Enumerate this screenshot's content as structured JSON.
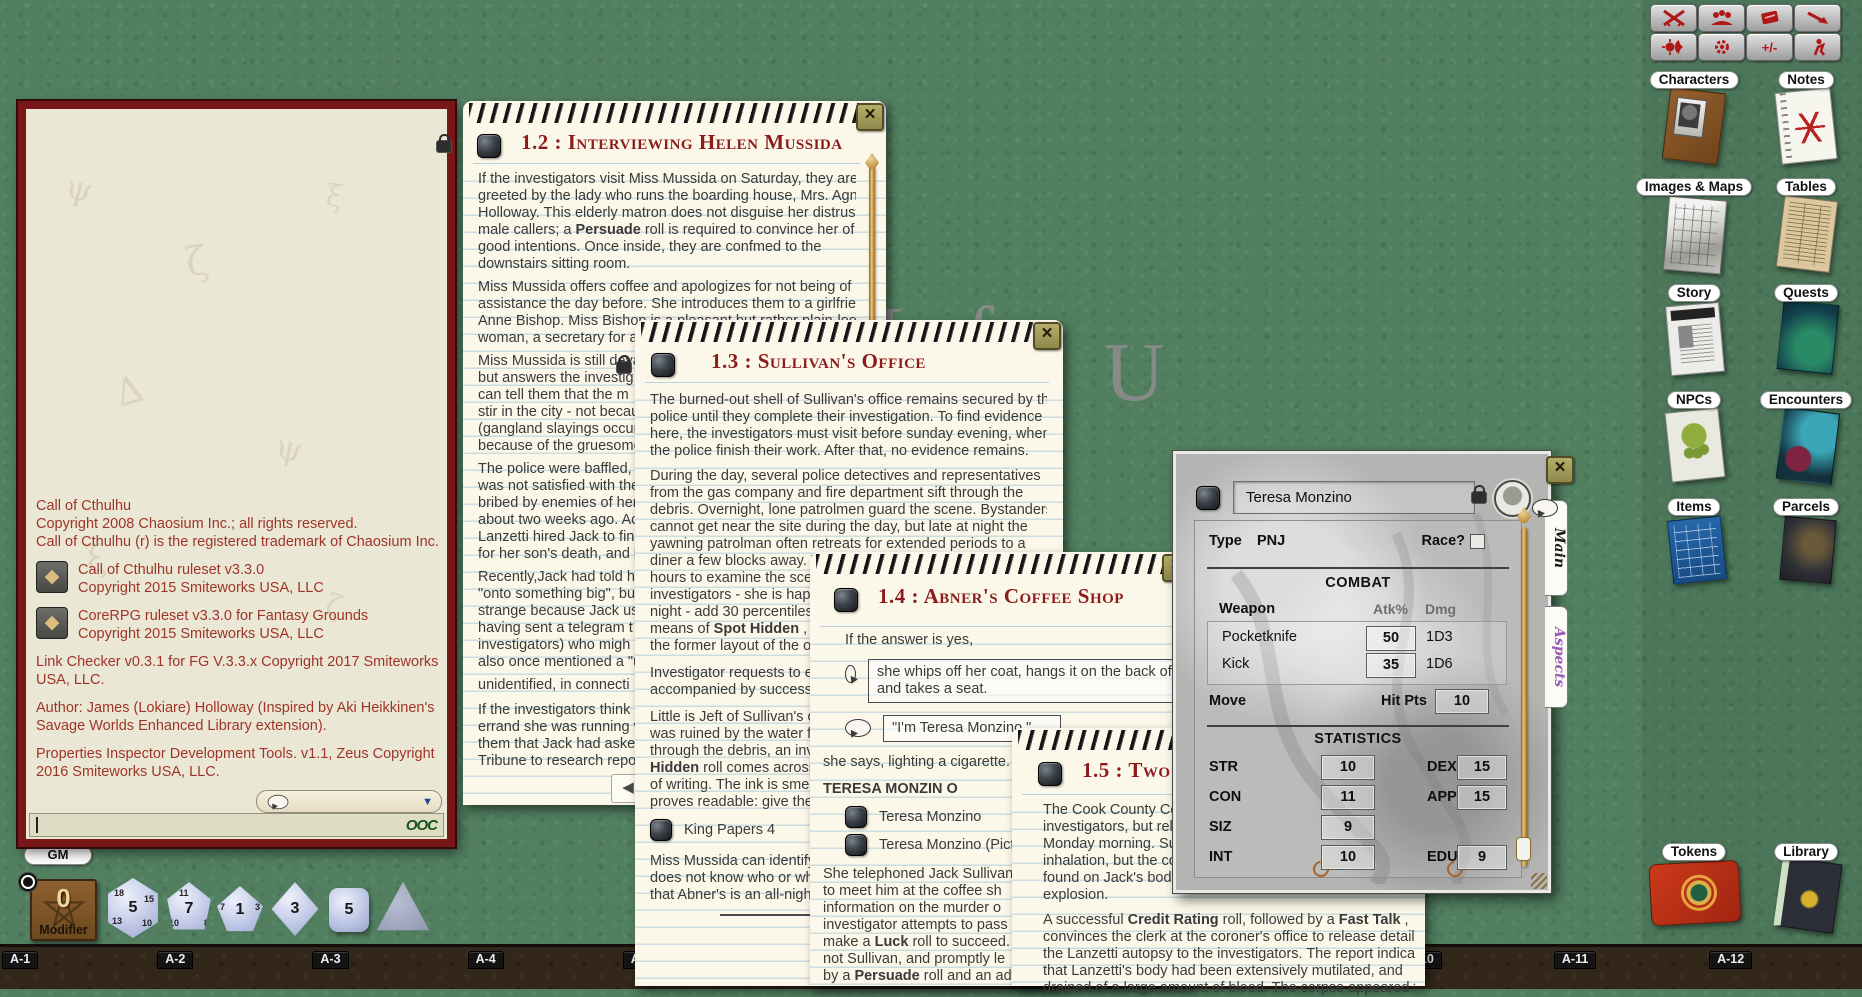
{
  "desktop": {
    "watermark_part1": "M of",
    "watermark_part2": "U",
    "background_green": "#517f60",
    "bottom_bar_brown": "#33261a"
  },
  "toolbar": {
    "icons": [
      "crossed-swords-icon",
      "people-icon",
      "red-deck-icon",
      "pointer-arrow-icon",
      "sun-moon-icon",
      "gear-icon",
      "plus-minus-icon",
      "person-icon"
    ],
    "plus_minus_label": "+/-",
    "accent_red": "#b01818"
  },
  "sidebar": {
    "items": [
      {
        "label": "Characters"
      },
      {
        "label": "Notes"
      },
      {
        "label": "Images & Maps"
      },
      {
        "label": "Tables"
      },
      {
        "label": "Story"
      },
      {
        "label": "Quests"
      },
      {
        "label": "NPCs"
      },
      {
        "label": "Encounters"
      },
      {
        "label": "Items"
      },
      {
        "label": "Parcels"
      },
      {
        "label": "Tokens"
      },
      {
        "label": "Library"
      }
    ]
  },
  "chat": {
    "msg1": "Call of Cthulhu",
    "msg2": "Copyright 2008 Chaosium Inc.; all rights reserved.",
    "msg3": "Call of Cthulhu (r) is the registered trademark of Chaosium Inc.",
    "ruleset1_line1": "Call of Cthulhu ruleset v3.3.0",
    "ruleset1_line2": "Copyright 2015 Smiteworks USA, LLC",
    "ruleset2_line1": "CoreRPG ruleset v3.3.0 for Fantasy Grounds",
    "ruleset2_line2": "Copyright 2015 Smiteworks USA, LLC",
    "msg4": "Link Checker v0.3.1 for FG V.3.3.x Copyright 2017 Smiteworks USA, LLC.",
    "msg5": "Author: James (Lokiare) Holloway (Inspired by Aki Heikkinen's Savage Worlds Enhanced Library extension).",
    "msg6": "Properties Inspector Development Tools. v1.1, Zeus Copyright 2016 Smiteworks USA, LLC.",
    "dice_icon": "d20-glyph",
    "ooc_label": "OOC",
    "dropdown_caret": "▼"
  },
  "gm_label": "GM",
  "modifier": {
    "value": "0",
    "label": "Modifier"
  },
  "dice": {
    "d20": {
      "main": "5",
      "f1": "18",
      "f2": "15",
      "f3": "13",
      "f4": "10"
    },
    "d12": {
      "main": "7",
      "f1": "11",
      "f2": "10",
      "f3": "8"
    },
    "d10": {
      "main": "1",
      "f1": "7",
      "f2": "3"
    },
    "d8": {
      "main": "3"
    },
    "d6": {
      "main": "5"
    }
  },
  "hotbar": {
    "slots": [
      "A-1",
      "A-2",
      "A-3",
      "A-4",
      "A-5",
      "A-6",
      "A-7",
      "A-8",
      "A-9",
      "A-10",
      "A-11",
      "A-12"
    ]
  },
  "win12": {
    "title": "1.2 : Interviewing Helen Mussida",
    "nav_left": "◀",
    "p1": [
      "If the investigators visit Miss Mussida on Saturday, they are",
      "greeted by the lady who runs the boarding house, Mrs. Agnes",
      "Holloway. This elderly matron does not disguise her distrust of",
      "male callers; a **Persuade** roll is required to convince her of their",
      "good intentions. Once inside, they are confmed to the",
      "downstairs sitting room."
    ],
    "p2": [
      "Miss Mussida offers coffee and apologizes for not being of more",
      "assistance the day before. She introduces them to a girlfriend,",
      "Anne Bishop. Miss Bishop is a pleasant but rather plain-looking",
      "woman, a secretary for a b"
    ],
    "p3": [
      "Miss Mussida is still devas",
      "but answers the investig",
      "can tell them that the m",
      "stir in the city - not becau",
      "(gangland slayings occur",
      "because of the gruesome"
    ],
    "p4": [
      "The police were baffled,",
      "was not satisfied with the",
      "bribed by enemies of her",
      "about two weeks ago. Ac",
      "Lanzetti hired Jack to fin",
      "for her son's death, and b"
    ],
    "p5": [
      "Recently,Jack had told hi",
      "\"onto something big\", bu",
      "strange because Jack usu",
      "having sent a telegram t",
      "investigators) who migh",
      "also once mentioned a \"u"
    ],
    "p6": [
      "unidentified, in connecti"
    ],
    "p7": [
      "If the investigators think",
      "errand she was running v",
      "them that Jack had asked",
      "Tribune to research repo"
    ]
  },
  "win13": {
    "title": "1.3 : Sullivan's Office",
    "p1": [
      "The burned-out shell of Sullivan's office remains secured by the",
      "police until they complete their investigation. To find evidence",
      "here, the investigators must visit before sunday evening, when",
      "the police finish their work. After that, no evidence remains."
    ],
    "p2": [
      "During the day, several police detectives and representatives",
      "from the gas company and fire department sift through the",
      "debris. Overnight, lone patrolmen guard the scene. Bystanders",
      "cannot get near the site during the day, but late at night the",
      "yawning patrolman often retreats for extended periods to a",
      "diner a few blocks away. Th",
      "hours to examine the scen",
      "investigators - she is happy",
      "night - add 30 percentiles t",
      "means of **Spot Hidden** , Lu",
      "the former layout of the o"
    ],
    "p3": [
      "Investigator requests to ex",
      "accompanied by successfu"
    ],
    "p4": [
      "Little is Jeft of Sullivan's o",
      "was ruined by the water f",
      "through the debris, an inv",
      "**Hidden** roll comes across",
      "of writing. The ink is smea",
      "proves readable: give the"
    ],
    "link1": "King Papers 4",
    "p5": [
      "Miss Mussida can identify",
      "does not know who or wh",
      "that Abner's is an all-night"
    ]
  },
  "win14": {
    "title": "1.4 : Abner's Coffee Shop",
    "intro": "If the answer is yes,",
    "quote1": [
      "she whips off her coat, hangs it on the back of th",
      "and takes a seat."
    ],
    "quote2": "\"I'm Teresa Monzino,\"",
    "after_quote": "she says, lighting a cigarette.",
    "npc_heading": "TERESA MONZIN O",
    "link1": "Teresa Monzino",
    "link2": "Teresa Monzino (Pictur",
    "para": [
      "She telephoned Jack Sullivan",
      "to meet him at the coffee sh",
      "information on the murder o",
      "investigator attempts to pass",
      "make a **Luck** roll to succeed.",
      "not Sullivan, and promptly le",
      "by a **Persuade** roll and an adv"
    ]
  },
  "win15": {
    "title": "1.5 : Two A",
    "p1": [
      "The Cook County Coro",
      "investigators, but rele",
      "Monday morning. Sul",
      "inhalation, but the co",
      "found on Jack's body a",
      "explosion."
    ],
    "p2": [
      "A successful **Credit Rating** roll, followed by a **Fast Talk** ,",
      "convinces the clerk at the coroner's office to release details of",
      "the Lanzetti autopsy to the investigators. The report indicates",
      "that Lanzetti's body had been extensively mutilated, and",
      "drained of a large amount of blood. The corpse appeared to"
    ]
  },
  "sheet": {
    "name": "Teresa Monzino",
    "type_label": "Type",
    "type_value": "PNJ",
    "race_label": "Race?",
    "combat": {
      "header": "COMBAT",
      "col_weapon": "Weapon",
      "col_atk": "Atk%",
      "col_dmg": "Dmg",
      "weapons": [
        {
          "name": "Pocketknife",
          "atk": "50",
          "dmg": "1D3"
        },
        {
          "name": "Kick",
          "atk": "35",
          "dmg": "1D6"
        }
      ],
      "move_label": "Move",
      "hitpts_label": "Hit Pts",
      "hitpts_value": "10"
    },
    "stats_header": "STATISTICS",
    "stats": {
      "str": {
        "label": "STR",
        "value": "10"
      },
      "dex": {
        "label": "DEX",
        "value": "15"
      },
      "con": {
        "label": "CON",
        "value": "11"
      },
      "app": {
        "label": "APP",
        "value": "15"
      },
      "siz": {
        "label": "SIZ",
        "value": "9"
      },
      "int": {
        "label": "INT",
        "value": "10"
      },
      "edu": {
        "label": "EDU",
        "value": "9"
      }
    },
    "tabs": [
      {
        "label": "Main"
      },
      {
        "label": "Aspects"
      }
    ],
    "tab_aspects_color": "#9a5ab8"
  }
}
